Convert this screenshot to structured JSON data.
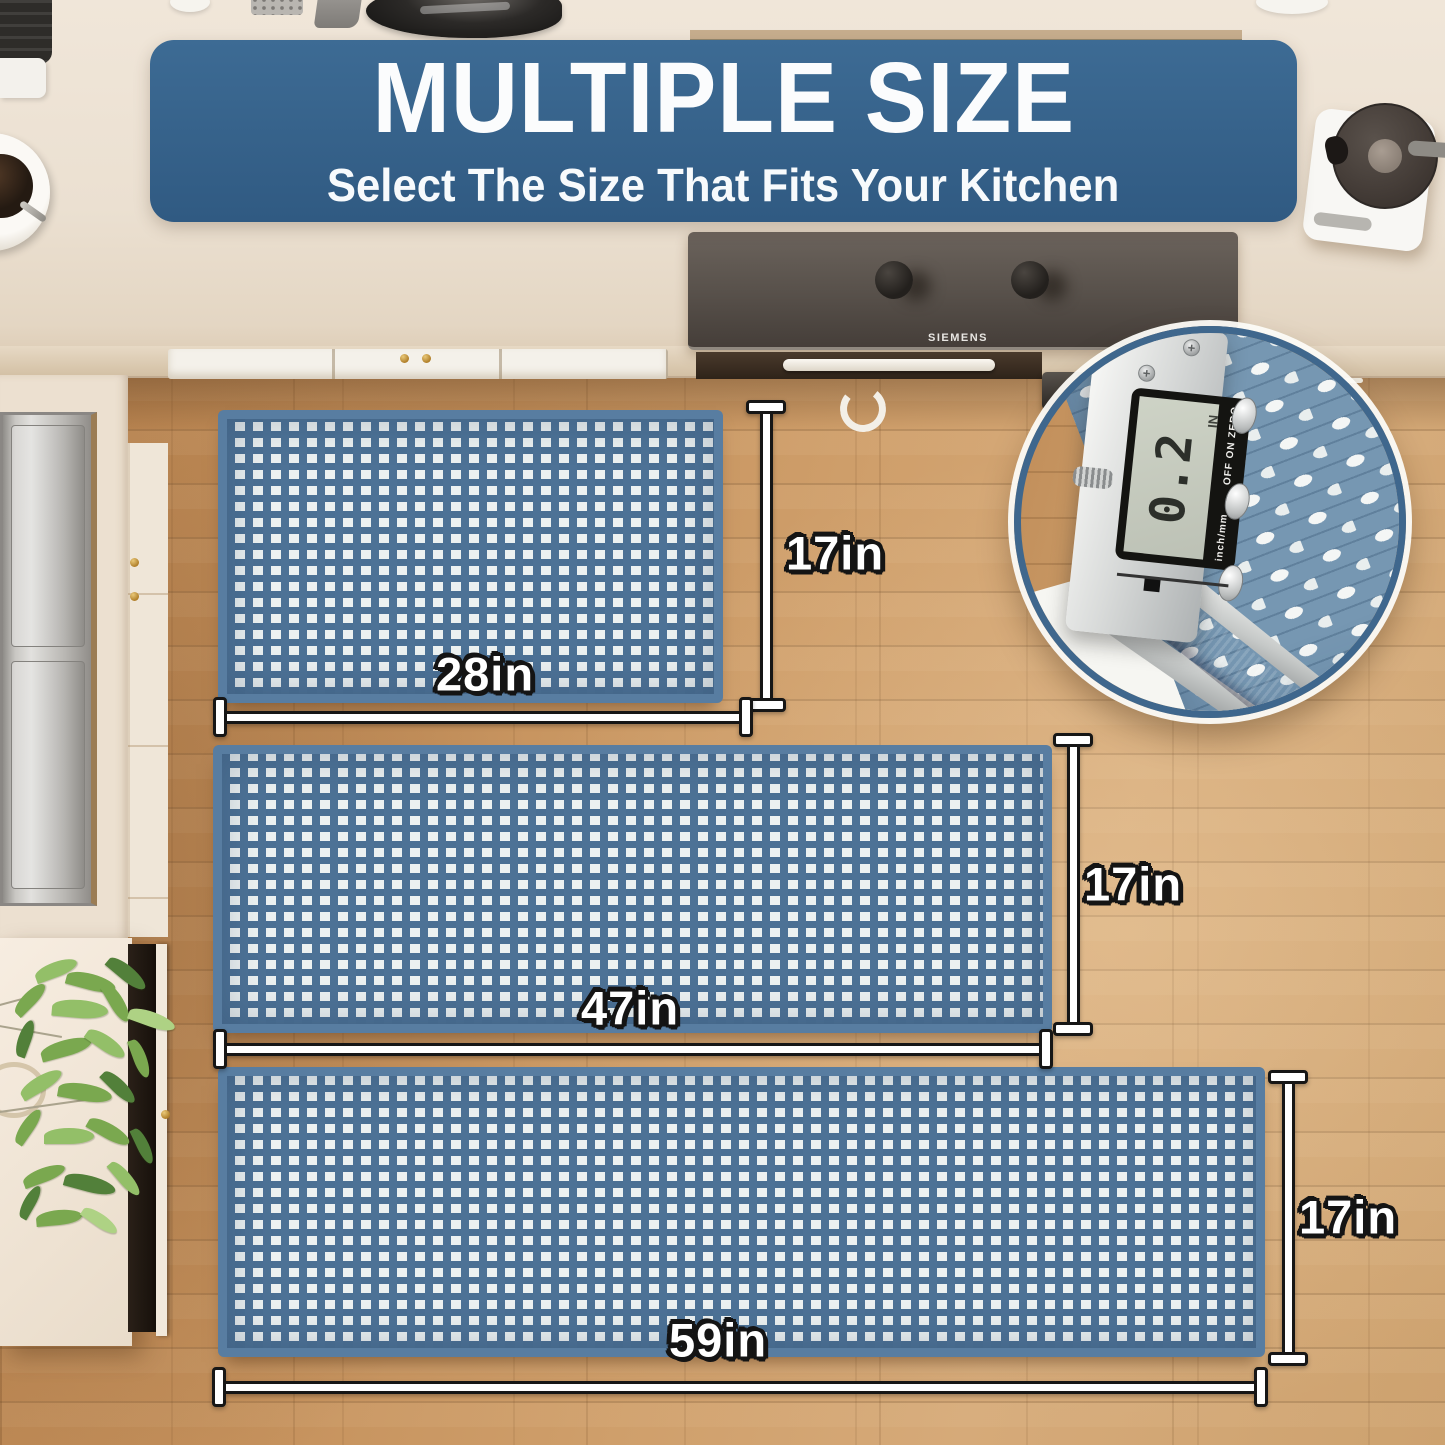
{
  "banner": {
    "title": "MULTIPLE SIZE",
    "subtitle": "Select The Size That Fits Your Kitchen"
  },
  "scene": {
    "hood_brand": "SIEMENS"
  },
  "mats": [
    {
      "name": "small mat",
      "width_label": "28in",
      "height_label": "17in"
    },
    {
      "name": "medium mat",
      "width_label": "47in",
      "height_label": "17in"
    },
    {
      "name": "runner mat",
      "width_label": "59in",
      "height_label": "17in"
    }
  ],
  "inset": {
    "reading": "0.2",
    "unit": "IN",
    "mode_label": "inch/mm",
    "buttons_label": "OFF ON ZERO"
  },
  "colors": {
    "banner_blue": "#35618a",
    "mat_blue": "#4d7296",
    "mat_white": "#ecf1f1",
    "wood": "#c9965f",
    "dimension_line_fill": "#ffffff",
    "dimension_line_outline": "#161616"
  }
}
